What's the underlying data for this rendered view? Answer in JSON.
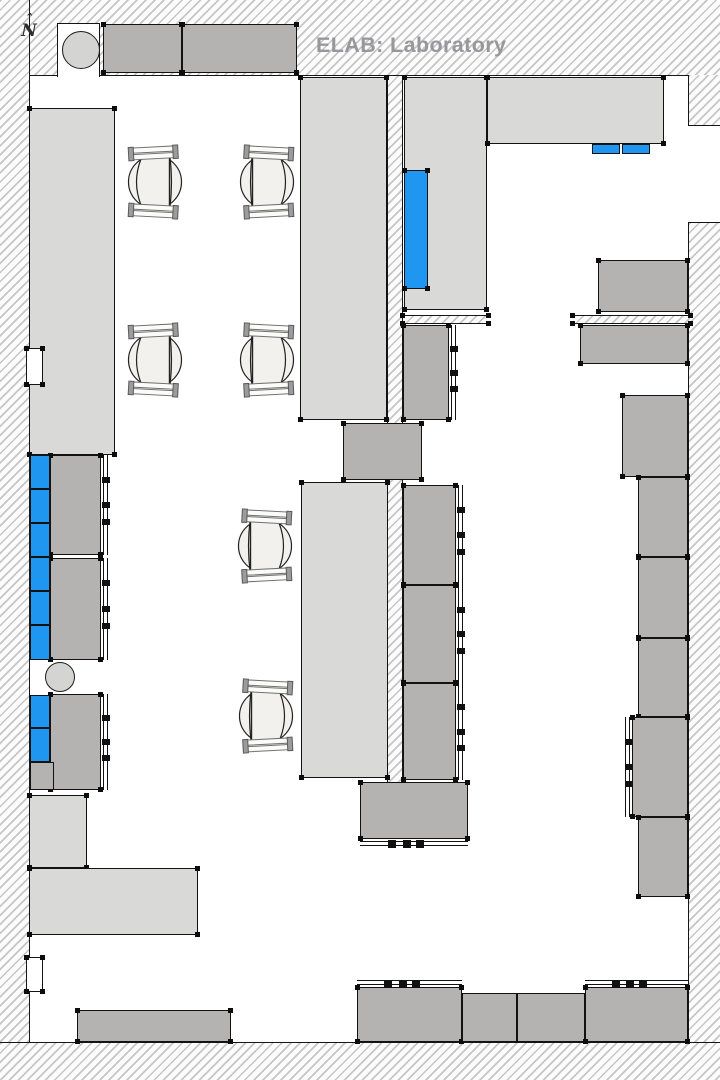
{
  "page": {
    "width": 720,
    "height": 1080
  },
  "title": {
    "text": "ELAB: Laboratory"
  },
  "north": {
    "caret": "ˆ",
    "label": "N"
  },
  "colors": {
    "bench_light": "#d9d9d8",
    "cabinet_dark": "#b4b3b1",
    "equipment_blue": "#1f97f0",
    "column_circle": "#d4d4d3",
    "title_gray": "#98989c",
    "outline": "#121212"
  },
  "floorplan": {
    "walls": [
      {
        "name": "wall-top",
        "x": 0,
        "y": 0,
        "w": 720,
        "h": 76,
        "edge": "bottom"
      },
      {
        "name": "wall-left",
        "x": 0,
        "y": 0,
        "w": 30,
        "h": 1080,
        "edge": "right"
      },
      {
        "name": "wall-bottom",
        "x": 0,
        "y": 1042,
        "w": 720,
        "h": 38,
        "edge": "top"
      },
      {
        "name": "wall-right-upper",
        "x": 688,
        "y": 75,
        "w": 32,
        "h": 50,
        "edge": "left"
      },
      {
        "name": "wall-right-lower",
        "x": 688,
        "y": 223,
        "w": 32,
        "h": 819,
        "edge": "left"
      },
      {
        "name": "wall-center-partition",
        "x": 387,
        "y": 76,
        "w": 16,
        "h": 707,
        "edge": "left right"
      },
      {
        "name": "wall-strip-left",
        "x": 403,
        "y": 315,
        "w": 85,
        "h": 9,
        "edge": "top bottom",
        "t": 1
      },
      {
        "name": "wall-strip-right",
        "x": 573,
        "y": 315,
        "w": 117,
        "h": 9,
        "edge": "top bottom",
        "t": 1
      }
    ],
    "openings": [
      {
        "name": "wall-recess-top-left",
        "x": 57,
        "y": 23,
        "w": 43,
        "h": 54,
        "borders": "ltr"
      },
      {
        "name": "wall-opening-right",
        "x": 688,
        "y": 125,
        "w": 32,
        "h": 98,
        "borders": "tb"
      }
    ],
    "notches": [
      {
        "name": "door-jamb-upper-left",
        "x": 26,
        "y": 348,
        "w": 17,
        "h": 37,
        "borders": "a",
        "t": 1
      },
      {
        "name": "door-jamb-lower-left",
        "x": 26,
        "y": 957,
        "w": 17,
        "h": 35,
        "borders": "a",
        "t": 1
      }
    ],
    "furniture_light": [
      {
        "name": "bench-left",
        "x": 29,
        "y": 108,
        "w": 86,
        "h": 347,
        "t": 1
      },
      {
        "name": "bench-top-center",
        "x": 300,
        "y": 77,
        "w": 87,
        "h": 343,
        "t": 1
      },
      {
        "name": "bench-right-of-partition",
        "x": 404,
        "y": 77,
        "w": 83,
        "h": 233,
        "t": 1
      },
      {
        "name": "bench-top-right",
        "x": 487,
        "y": 77,
        "w": 177,
        "h": 67,
        "t": 1
      },
      {
        "name": "bench-middle",
        "x": 301,
        "y": 482,
        "w": 87,
        "h": 296,
        "t": 1
      },
      {
        "name": "counter-lower-left-vertical",
        "x": 29,
        "y": 795,
        "w": 58,
        "h": 73,
        "t": 1
      },
      {
        "name": "counter-lower-left-horizontal",
        "x": 29,
        "y": 868,
        "w": 169,
        "h": 67,
        "t": 1
      }
    ],
    "furniture_dark": [
      {
        "name": "cabinet-top-a",
        "x": 103,
        "y": 24,
        "w": 79,
        "h": 49,
        "t": 1
      },
      {
        "name": "cabinet-top-b",
        "x": 182,
        "y": 24,
        "w": 115,
        "h": 49,
        "t": 1
      },
      {
        "name": "cabinet-connector-mid",
        "x": 343,
        "y": 423,
        "w": 79,
        "h": 57,
        "t": 1
      },
      {
        "name": "cabinet-below-strip-left",
        "x": 403,
        "y": 325,
        "w": 46,
        "h": 95,
        "t": 1,
        "de": "right"
      },
      {
        "name": "cabinet-right-top",
        "x": 598,
        "y": 260,
        "w": 90,
        "h": 52,
        "t": 1
      },
      {
        "name": "cabinet-right-2",
        "x": 580,
        "y": 325,
        "w": 108,
        "h": 39,
        "t": 1
      },
      {
        "name": "cabinet-right-3",
        "x": 622,
        "y": 395,
        "w": 66,
        "h": 82,
        "t": 1
      },
      {
        "name": "cabinet-right-4",
        "x": 638,
        "y": 477,
        "w": 50,
        "h": 80,
        "t": 1
      },
      {
        "name": "cabinet-right-5",
        "x": 638,
        "y": 557,
        "w": 50,
        "h": 81,
        "t": 1
      },
      {
        "name": "cabinet-right-6",
        "x": 638,
        "y": 638,
        "w": 50,
        "h": 79,
        "t": 1
      },
      {
        "name": "cabinet-right-7",
        "x": 632,
        "y": 717,
        "w": 56,
        "h": 100,
        "t": 1,
        "de": "left"
      },
      {
        "name": "cabinet-right-8",
        "x": 638,
        "y": 817,
        "w": 50,
        "h": 80,
        "t": 1
      },
      {
        "name": "cabinet-mid-right-a",
        "x": 403,
        "y": 485,
        "w": 53,
        "h": 100,
        "t": 1,
        "de": "right"
      },
      {
        "name": "cabinet-mid-right-b",
        "x": 403,
        "y": 585,
        "w": 53,
        "h": 98,
        "t": 1,
        "de": "right"
      },
      {
        "name": "cabinet-mid-right-c",
        "x": 403,
        "y": 683,
        "w": 53,
        "h": 97,
        "t": 1,
        "de": "right"
      },
      {
        "name": "cabinet-mid-lower",
        "x": 360,
        "y": 782,
        "w": 108,
        "h": 57,
        "t": 1,
        "de": "bottom"
      },
      {
        "name": "bench-bottom-1",
        "x": 357,
        "y": 987,
        "w": 105,
        "h": 55,
        "t": 1,
        "de": "top"
      },
      {
        "name": "bench-bottom-2",
        "x": 462,
        "y": 993,
        "w": 55,
        "h": 49
      },
      {
        "name": "bench-bottom-3",
        "x": 517,
        "y": 993,
        "w": 68,
        "h": 49
      },
      {
        "name": "bench-bottom-4",
        "x": 585,
        "y": 987,
        "w": 103,
        "h": 55,
        "t": 1,
        "de": "top"
      },
      {
        "name": "bench-bottom-left",
        "x": 77,
        "y": 1010,
        "w": 154,
        "h": 32,
        "t": 1
      },
      {
        "name": "cabinet-left-block1-unit-a",
        "x": 50,
        "y": 455,
        "w": 51,
        "h": 100,
        "t": 1,
        "de": "right"
      },
      {
        "name": "cabinet-left-block1-unit-b",
        "x": 50,
        "y": 558,
        "w": 51,
        "h": 102,
        "t": 1,
        "de": "right"
      },
      {
        "name": "cabinet-left-block2-unit",
        "x": 50,
        "y": 694,
        "w": 51,
        "h": 96,
        "t": 1,
        "de": "right"
      },
      {
        "name": "cabinet-left-block2-base",
        "x": 30,
        "y": 762,
        "w": 24,
        "h": 28
      }
    ],
    "equipment_blue": [
      {
        "name": "equipment-blue-partition",
        "x": 404,
        "y": 170,
        "w": 24,
        "h": 119,
        "t": 1
      },
      {
        "name": "equipment-blue-top-a",
        "x": 592,
        "y": 144,
        "w": 28,
        "h": 10
      },
      {
        "name": "equipment-blue-top-b",
        "x": 622,
        "y": 144,
        "w": 28,
        "h": 10
      },
      {
        "name": "reagent-cell-1",
        "x": 30,
        "y": 455,
        "w": 20,
        "h": 34
      },
      {
        "name": "reagent-cell-2",
        "x": 30,
        "y": 489,
        "w": 20,
        "h": 34
      },
      {
        "name": "reagent-cell-3",
        "x": 30,
        "y": 523,
        "w": 20,
        "h": 34
      },
      {
        "name": "reagent-cell-4",
        "x": 30,
        "y": 557,
        "w": 20,
        "h": 34
      },
      {
        "name": "reagent-cell-5",
        "x": 30,
        "y": 591,
        "w": 20,
        "h": 34
      },
      {
        "name": "reagent-cell-6",
        "x": 30,
        "y": 625,
        "w": 20,
        "h": 35
      },
      {
        "name": "reagent-cell-7",
        "x": 30,
        "y": 695,
        "w": 20,
        "h": 33
      },
      {
        "name": "reagent-cell-8",
        "x": 30,
        "y": 728,
        "w": 20,
        "h": 34
      }
    ],
    "circles": [
      {
        "name": "column-top-left",
        "cx": 81,
        "cy": 50,
        "r": 19
      },
      {
        "name": "column-mid-left",
        "cx": 60,
        "cy": 677,
        "r": 15
      }
    ],
    "chairs": [
      {
        "name": "chair-1",
        "x": 127,
        "y": 144,
        "facing": "left"
      },
      {
        "name": "chair-2",
        "x": 239,
        "y": 144,
        "facing": "right"
      },
      {
        "name": "chair-3",
        "x": 127,
        "y": 322,
        "facing": "left"
      },
      {
        "name": "chair-4",
        "x": 239,
        "y": 322,
        "facing": "right"
      },
      {
        "name": "chair-5",
        "x": 237,
        "y": 508,
        "facing": "right"
      },
      {
        "name": "chair-6",
        "x": 238,
        "y": 678,
        "facing": "right"
      }
    ]
  }
}
